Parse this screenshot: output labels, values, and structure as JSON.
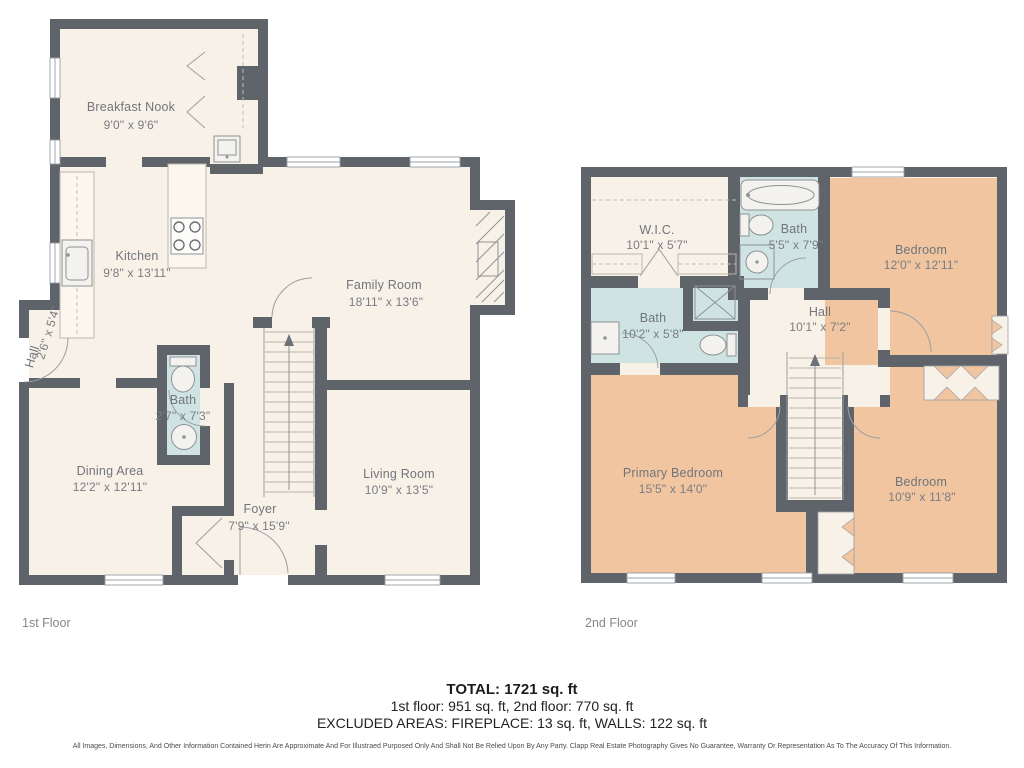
{
  "floors": [
    {
      "name": "1st Floor",
      "rooms": [
        {
          "label": "Breakfast Nook",
          "dims": "9'0\" x 9'6\""
        },
        {
          "label": "Kitchen",
          "dims": "9'8\" x 13'11\""
        },
        {
          "label": "Family Room",
          "dims": "18'11\" x 13'6\""
        },
        {
          "label": "Hall",
          "dims": "2'6\" x 5'4\""
        },
        {
          "label": "Bath",
          "dims": "2'7\" x 7'3\""
        },
        {
          "label": "Dining Area",
          "dims": "12'2\" x 12'11\""
        },
        {
          "label": "Foyer",
          "dims": "7'9\" x 15'9\""
        },
        {
          "label": "Living Room",
          "dims": "10'9\" x 13'5\""
        }
      ]
    },
    {
      "name": "2nd Floor",
      "rooms": [
        {
          "label": "W.I.C.",
          "dims": "10'1\" x 5'7\""
        },
        {
          "label": "Bath",
          "dims": "5'5\" x 7'9\""
        },
        {
          "label": "Bedroom",
          "dims": "12'0\" x 12'11\""
        },
        {
          "label": "Bath",
          "dims": "10'2\" x 5'8\""
        },
        {
          "label": "Hall",
          "dims": "10'1\" x 7'2\""
        },
        {
          "label": "Primary Bedroom",
          "dims": "15'5\" x 14'0\""
        },
        {
          "label": "Bedroom",
          "dims": "10'9\" x 11'8\""
        }
      ]
    }
  ],
  "summary": {
    "total": "TOTAL: 1721 sq. ft",
    "floors_breakdown": "1st floor: 951 sq. ft, 2nd floor: 770 sq. ft",
    "excluded": "EXCLUDED AREAS: FIREPLACE: 13 sq. ft, WALLS: 122 sq. ft"
  },
  "disclaimer": "All Images, Dimensions, And Other Information Contained Herin Are Approximate And For Illustraed Purposed Only And Shall Not Be Relied Upon By Any Party. Clapp Real Estate Photography Gives No Guarantee, Warranty Or Representation As To The Accuracy Of This Information.",
  "colors": {
    "wall": "#5f636a",
    "floor": "#f8f1e7",
    "bath": "#cfe3e2",
    "bedroom": "#f0c5a0"
  }
}
